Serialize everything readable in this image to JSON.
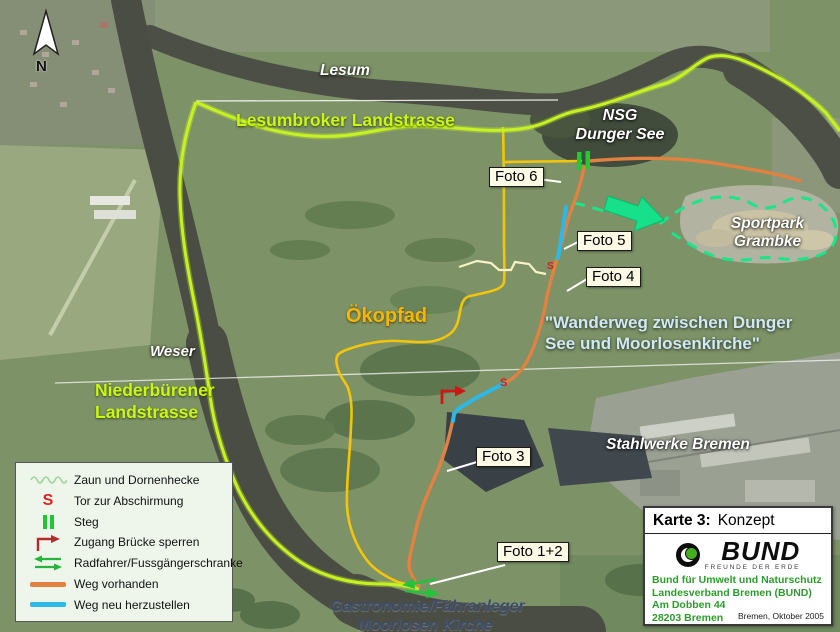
{
  "compass": {
    "label": "N"
  },
  "map_labels": {
    "lesum": "Lesum",
    "lesumbroker": "Lesumbroker Landstrasse",
    "nsg_line1": "NSG",
    "nsg_line2": "Dunger See",
    "sportpark_line1": "Sportpark",
    "sportpark_line2": "Grambke",
    "wanderweg_line1": "\"Wanderweg zwischen Dunger",
    "wanderweg_line2": "See und Moorlosenkirche\"",
    "okopfad": "Ökopfad",
    "weser": "Weser",
    "niederbuerener_line1": "Niederbürener",
    "niederbuerener_line2": "Landstrasse",
    "stahlwerke": "Stahlwerke Bremen",
    "gastronomie_line1": "Gastronomie/Fähranleger",
    "gastronomie_line2": "Moorlosen Kirche"
  },
  "foto_labels": {
    "foto6": "Foto 6",
    "foto5": "Foto 5",
    "foto4": "Foto 4",
    "foto3": "Foto 3",
    "foto12": "Foto 1+2"
  },
  "map_symbols": {
    "gate_text": "S"
  },
  "legend": {
    "items": [
      {
        "id": "fence",
        "label": "Zaun und Dornenhecke"
      },
      {
        "id": "gate",
        "label": "Tor zur Abschirmung",
        "symbol_text": "S"
      },
      {
        "id": "footbridge",
        "label": "Steg"
      },
      {
        "id": "block-bridge",
        "label": "Zugang Brücke sperren"
      },
      {
        "id": "barrier",
        "label": "Radfahrer/Fussgängerschranke"
      },
      {
        "id": "path-existing",
        "label": "Weg vorhanden"
      },
      {
        "id": "path-new",
        "label": "Weg neu herzustellen"
      }
    ]
  },
  "info_box": {
    "title_prefix": "Karte 3:",
    "title": "Konzept",
    "logo_text": "BUND",
    "logo_subtext": "FREUNDE DER ERDE",
    "address_line1": "Bund für Umwelt und Naturschutz",
    "address_line2": "Landesverband Bremen (BUND)",
    "address_line3": "Am Dobben 44",
    "address_line4": "28203 Bremen",
    "date": "Bremen, Oktober 2005"
  },
  "colors": {
    "boundary_hedge": "#c6f224",
    "path_existing": "#e28140",
    "path_new": "#2cb9e8",
    "okopfad_path": "#f2c50a",
    "nature_area_boundary": "#1de389",
    "gate_red": "#e01818",
    "water": "#4c4f45"
  }
}
